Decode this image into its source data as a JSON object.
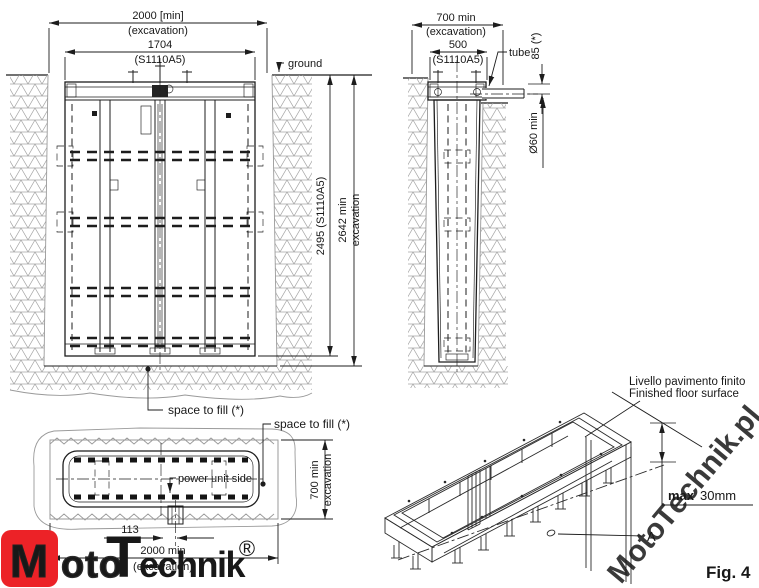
{
  "front_view": {
    "dim_excavation_width": "2000  [min]",
    "dim_excavation_width_sub": "(excavation)",
    "dim_frame_width": "1704",
    "dim_frame_width_sub": "(S1110A5)",
    "ground_label": "ground",
    "dim_frame_depth": "2495 (S1110A5)",
    "dim_excavation_depth_line1": "2642  min",
    "dim_excavation_depth_line2": "excavation",
    "space_to_fill_label": "space to fill (*)"
  },
  "side_view": {
    "dim_excavation_width": "700  min",
    "dim_excavation_width_sub": "(excavation)",
    "dim_frame_width": "500",
    "dim_frame_width_sub": "(S1110A5)",
    "tube_label": "tube",
    "dim_tube_height": "85  (*)",
    "dim_tube_diameter": "Ø60  min"
  },
  "plan_view": {
    "space_to_fill_label": "space to fill (*)",
    "power_unit_label": "power unit side",
    "dim_excavation_depth_line1": "700  min",
    "dim_excavation_depth_line2": "excavation",
    "dim_tube_offset": "113",
    "dim_excavation_width": "2000  min",
    "dim_excavation_width_sub": "(excavation)"
  },
  "iso_view": {
    "floor_label_it": "Livello pavimento finito",
    "floor_label_en": "Finished floor surface",
    "max_label": "max",
    "max_value": "30mm",
    "detail_label": "A",
    "figure_label": "Fig. 4"
  },
  "branding": {
    "logo_m": "M",
    "logo_oto": "oto",
    "logo_t": "T",
    "logo_echnik": "echnik",
    "logo_reg": "®",
    "watermark_m": "M",
    "watermark_oto": "oto",
    "watermark_t": "T",
    "watermark_rest": "echnik.pl"
  },
  "colors": {
    "line": "#1d1d1d",
    "hatch": "#a5a5a5",
    "logo_red": "#ec2227",
    "watermark_grey": "#c2c2c2",
    "watermark_red": "#e0524b"
  }
}
